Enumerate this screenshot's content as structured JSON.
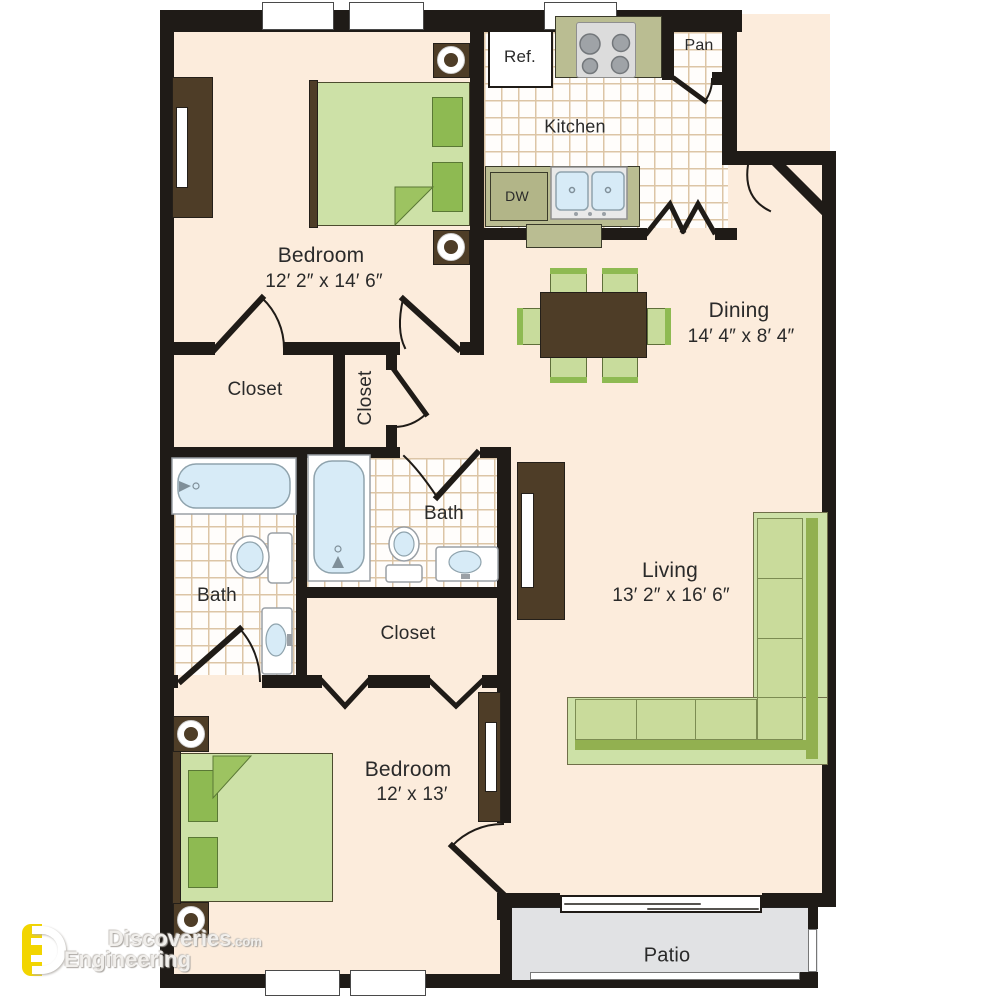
{
  "title": "Two bedroom apartment floor plan",
  "rooms": [
    {
      "id": "bedroom1",
      "label": "Bedroom",
      "dims": "12′ 2″ x 14′ 6″"
    },
    {
      "id": "kitchen",
      "label": "Kitchen"
    },
    {
      "id": "pantry",
      "label": "Pan"
    },
    {
      "id": "dining",
      "label": "Dining",
      "dims": "14′ 4″ x 8′ 4″"
    },
    {
      "id": "closet1",
      "label": "Closet"
    },
    {
      "id": "closet2",
      "label": "Closet"
    },
    {
      "id": "bath1",
      "label": "Bath"
    },
    {
      "id": "bath2",
      "label": "Bath"
    },
    {
      "id": "closet3",
      "label": "Closet"
    },
    {
      "id": "living",
      "label": "Living",
      "dims": "13′ 2″ x 16′ 6″"
    },
    {
      "id": "bedroom2",
      "label": "Bedroom",
      "dims": "12′ x 13′"
    },
    {
      "id": "patio",
      "label": "Patio"
    }
  ],
  "appliances": {
    "refrigerator": "Ref.",
    "dishwasher": "DW"
  },
  "watermark": {
    "brand": "Discoveries",
    "brand_suffix": ".com",
    "line2": "Engineering"
  },
  "palette": {
    "floor": "#fcecdc",
    "wall": "#1f1b17",
    "furniture_brown": "#4e3d27",
    "bed_green": "#cde1a7",
    "accent_green": "#8eba52",
    "counter_olive": "#babd92",
    "fixture_blue": "#d7ebf7",
    "patio_gray": "#e1e2e4",
    "tile_line": "#dcc5a6",
    "watermark_yellow": "#f2d500"
  }
}
